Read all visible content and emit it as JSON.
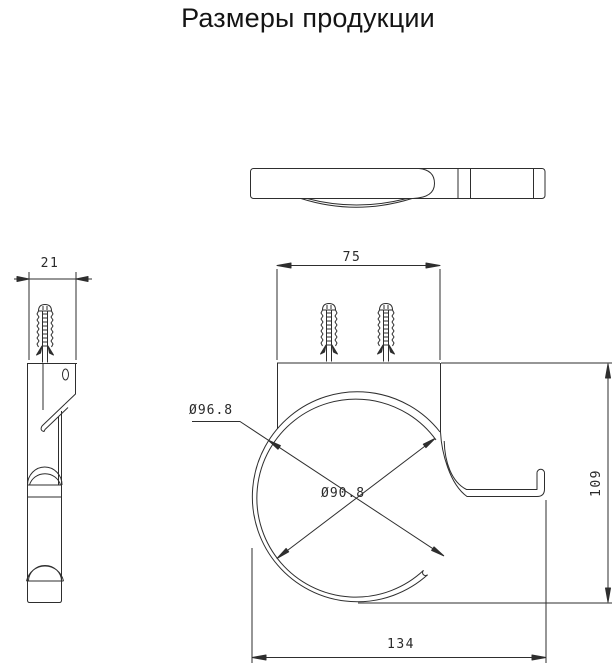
{
  "title": "Размеры продукции",
  "views": {
    "side": {
      "width_dim": "21"
    },
    "front": {
      "screw_spacing_dim": "75",
      "overall_width_dim": "134",
      "height_dim": "109",
      "outer_diameter_dim": "Ø96.8",
      "inner_diameter_dim": "Ø90.8"
    }
  },
  "colors": {
    "background": "#ffffff",
    "line": "#2e2e2e",
    "text": "#2a2a2a"
  }
}
